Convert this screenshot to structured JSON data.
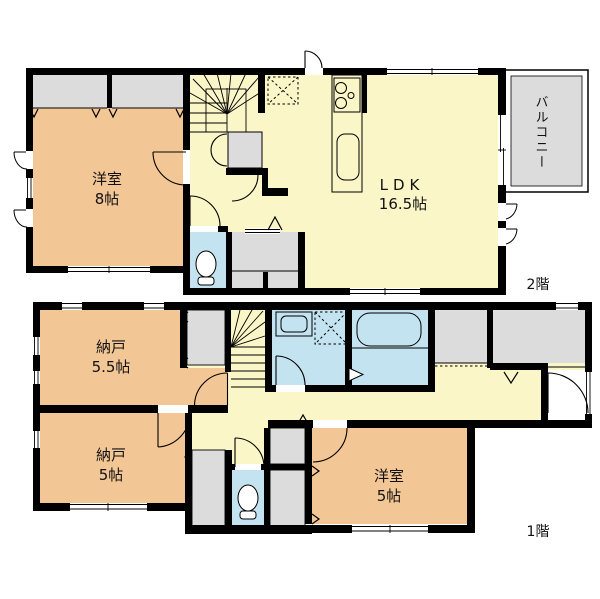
{
  "colors": {
    "wall": "#000000",
    "room_orange": "#F3C795",
    "room_yellow": "#FAF6C7",
    "room_blue": "#C3E3F1",
    "room_gray": "#DCDCDC"
  },
  "floor2": {
    "label": "2階",
    "rooms": {
      "yoshitsu8": {
        "name": "洋室",
        "size": "8帖"
      },
      "ldk": {
        "name": "LDK",
        "size": "16.5帖"
      },
      "balcony": {
        "name": "バルコニー"
      }
    }
  },
  "floor1": {
    "label": "1階",
    "rooms": {
      "nando55": {
        "name": "納戸",
        "size": "5.5帖"
      },
      "nando5": {
        "name": "納戸",
        "size": "5帖"
      },
      "yoshitsu5": {
        "name": "洋室",
        "size": "5帖"
      }
    }
  }
}
